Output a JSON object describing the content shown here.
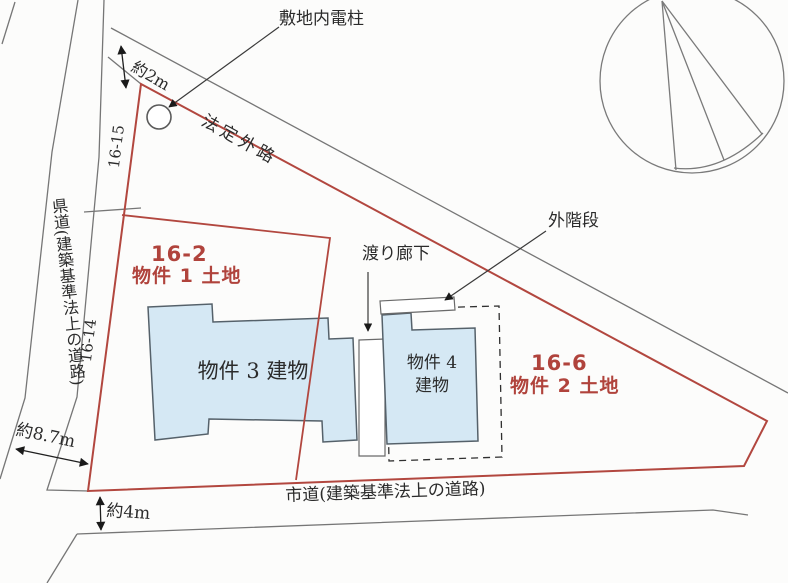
{
  "diagram": {
    "pole_label": "敷地内電柱",
    "hotei_road": "法定外路",
    "dim_2m": "約2m",
    "lot_16_15": "16-15",
    "lot_16_14": "16-14",
    "pref_road": "県道(建築基準法上の道路)",
    "dim_8_7m": "約8.7m",
    "dim_4m": "約4m",
    "city_road": "市道(建築基準法上の道路)",
    "parcel1": {
      "number": "16-2",
      "name": "物件 1 土地"
    },
    "parcel2": {
      "number": "16-6",
      "name": "物件 2 土地"
    },
    "building3": "物件 3 建物",
    "building4_line1": "物件 4",
    "building4_line2": "建物",
    "stairs_label": "外階段",
    "corridor_label": "渡り廊下"
  },
  "colors": {
    "parcel_boundary_red": "#b2473f",
    "parcel_text_red": "#b0433c",
    "building_fill_blue": "#d5e8f4",
    "building_border": "#55616a",
    "road_line_grey": "#767676",
    "text_black": "#2b2b2b",
    "paper": "#fcfcfb"
  }
}
